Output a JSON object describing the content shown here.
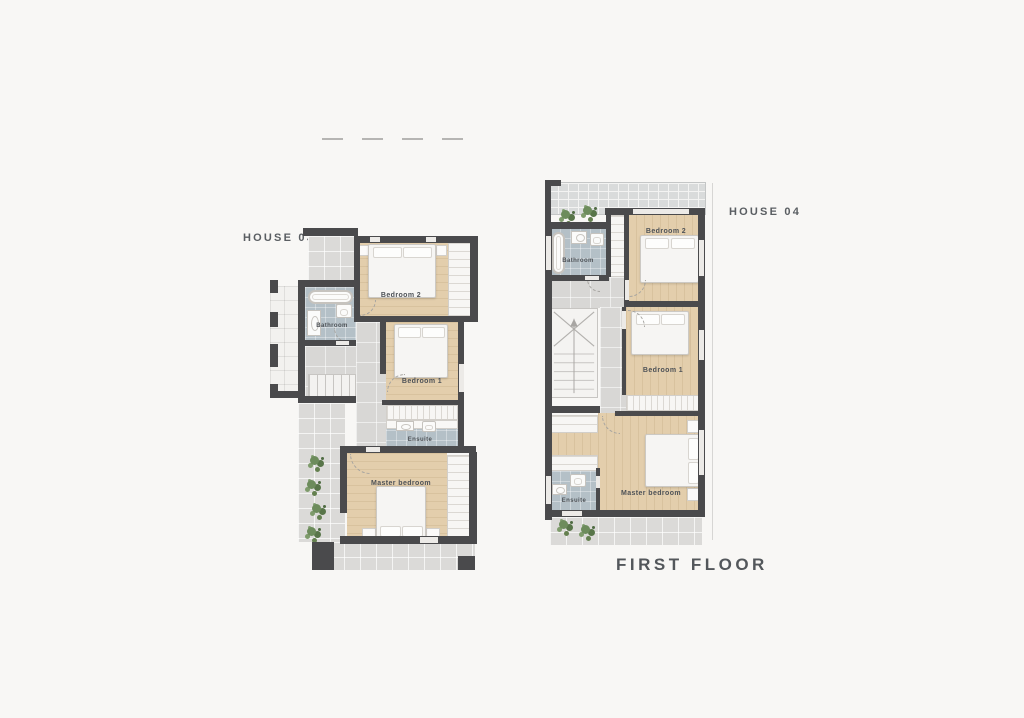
{
  "title": "FIRST FLOOR",
  "house03": {
    "label": "HOUSE 03",
    "rooms": {
      "bedroom2": "Bedroom 2",
      "bathroom": "Bathroom",
      "bedroom1": "Bedroom 1",
      "ensuite": "Ensuite",
      "master_bedroom": "Master bedroom"
    }
  },
  "house04": {
    "label": "HOUSE 04",
    "rooms": {
      "bedroom2": "Bedroom 2",
      "bathroom": "Bathroom",
      "bedroom1": "Bedroom 1",
      "ensuite": "Ensuite",
      "master_bedroom": "Master bedroom"
    }
  },
  "colors": {
    "background": "#f8f7f5",
    "wall": "#4a4a4c",
    "wood": "#e3ceac",
    "bath": "#b4c0c7",
    "concrete": "#d8d7d5",
    "terrace": "#dbdad8",
    "whitetile": "#f2f1ef",
    "label": "#4e5257",
    "title": "#53575b"
  }
}
